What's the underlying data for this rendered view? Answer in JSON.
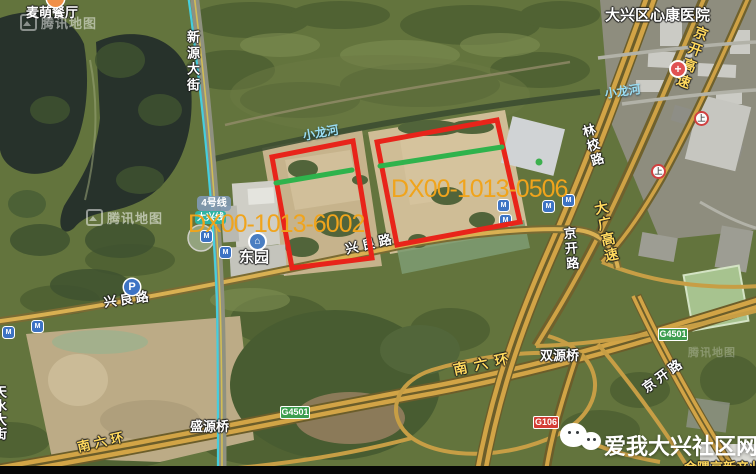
{
  "poi": {
    "restaurant": "麦萌餐厅",
    "hospital": "大兴区心康医院",
    "metro_station": "东园"
  },
  "roads": {
    "xinyuan_dajie": "新源大街",
    "jingkai_expressway": "京开高速",
    "daguang_expressway": "大广高速",
    "jingkai_road": "京开路",
    "linxiao_road": "林校路",
    "xingliang_road": "兴良路",
    "nanliuhuan": "南六环",
    "tianshui_dajie": "天水大街",
    "shuangyuan_bridge": "双源桥",
    "shengyuan_bridge": "盛源桥",
    "xiaolong_river": "小龙河"
  },
  "route_badges": {
    "line4": "4号线",
    "daxing_line": "大兴线",
    "g4501": "G4501",
    "g106": "G106"
  },
  "parcels": [
    {
      "id": "DX00-1013-6002"
    },
    {
      "id": "DX00-1013-0506"
    }
  ],
  "branding": {
    "community_name": "爱我大兴社区网"
  },
  "partial_label": "金隅京新产业",
  "watermark": {
    "text": "腾讯地图"
  },
  "icons": {
    "metro_logo": "M",
    "parking": "P",
    "highway_entrance": "上",
    "hospital_cross": "+",
    "station_house": "⌂"
  },
  "colors": {
    "parcel_outline": "#e8241a",
    "parcel_green_line": "#2fb34c",
    "parcel_label": "#f0a41c",
    "expressway_label": "#ffd95e",
    "river_label": "#9adcf2",
    "metro_line": "#45cede"
  }
}
